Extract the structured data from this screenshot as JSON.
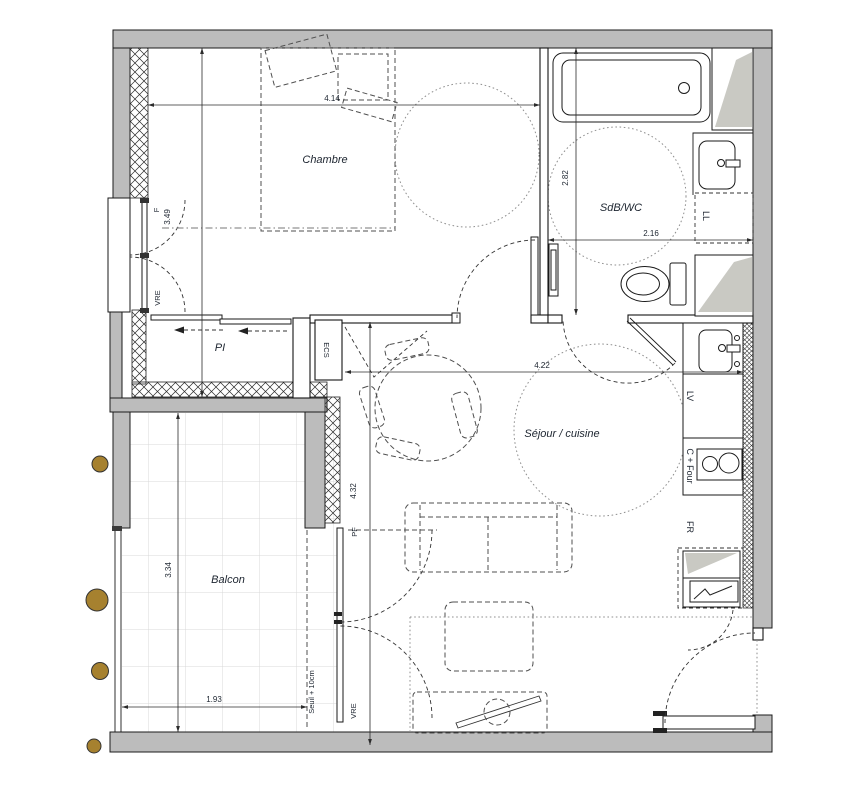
{
  "plan": {
    "rooms": {
      "chambre": "Chambre",
      "sdb_wc": "SdB/WC",
      "sejour_cuisine": "Séjour / cuisine",
      "balcon": "Balcon",
      "placard": "PI"
    },
    "equipment": {
      "water_heater": "ECS",
      "dishwasher": "LV",
      "cooktop_oven": "C + Four",
      "fridge": "FR",
      "washer": "LL"
    },
    "openings": {
      "window": "F",
      "roller_shutter": "VRE",
      "french_window": "PF",
      "threshold": "Seuil + 10cm"
    },
    "dimensions": {
      "chambre_width": "4.14",
      "chambre_depth": "3.49",
      "sdb_depth": "2.82",
      "sdb_width": "2.16",
      "sejour_width": "4.22",
      "sejour_depth": "4.32",
      "balcon_width": "1.93",
      "balcon_depth": "3.34"
    },
    "colors": {
      "wall_gray": "#bcbcbc",
      "shaft_shading": "#c9c9c3",
      "planter_brown": "#a6812f"
    }
  }
}
